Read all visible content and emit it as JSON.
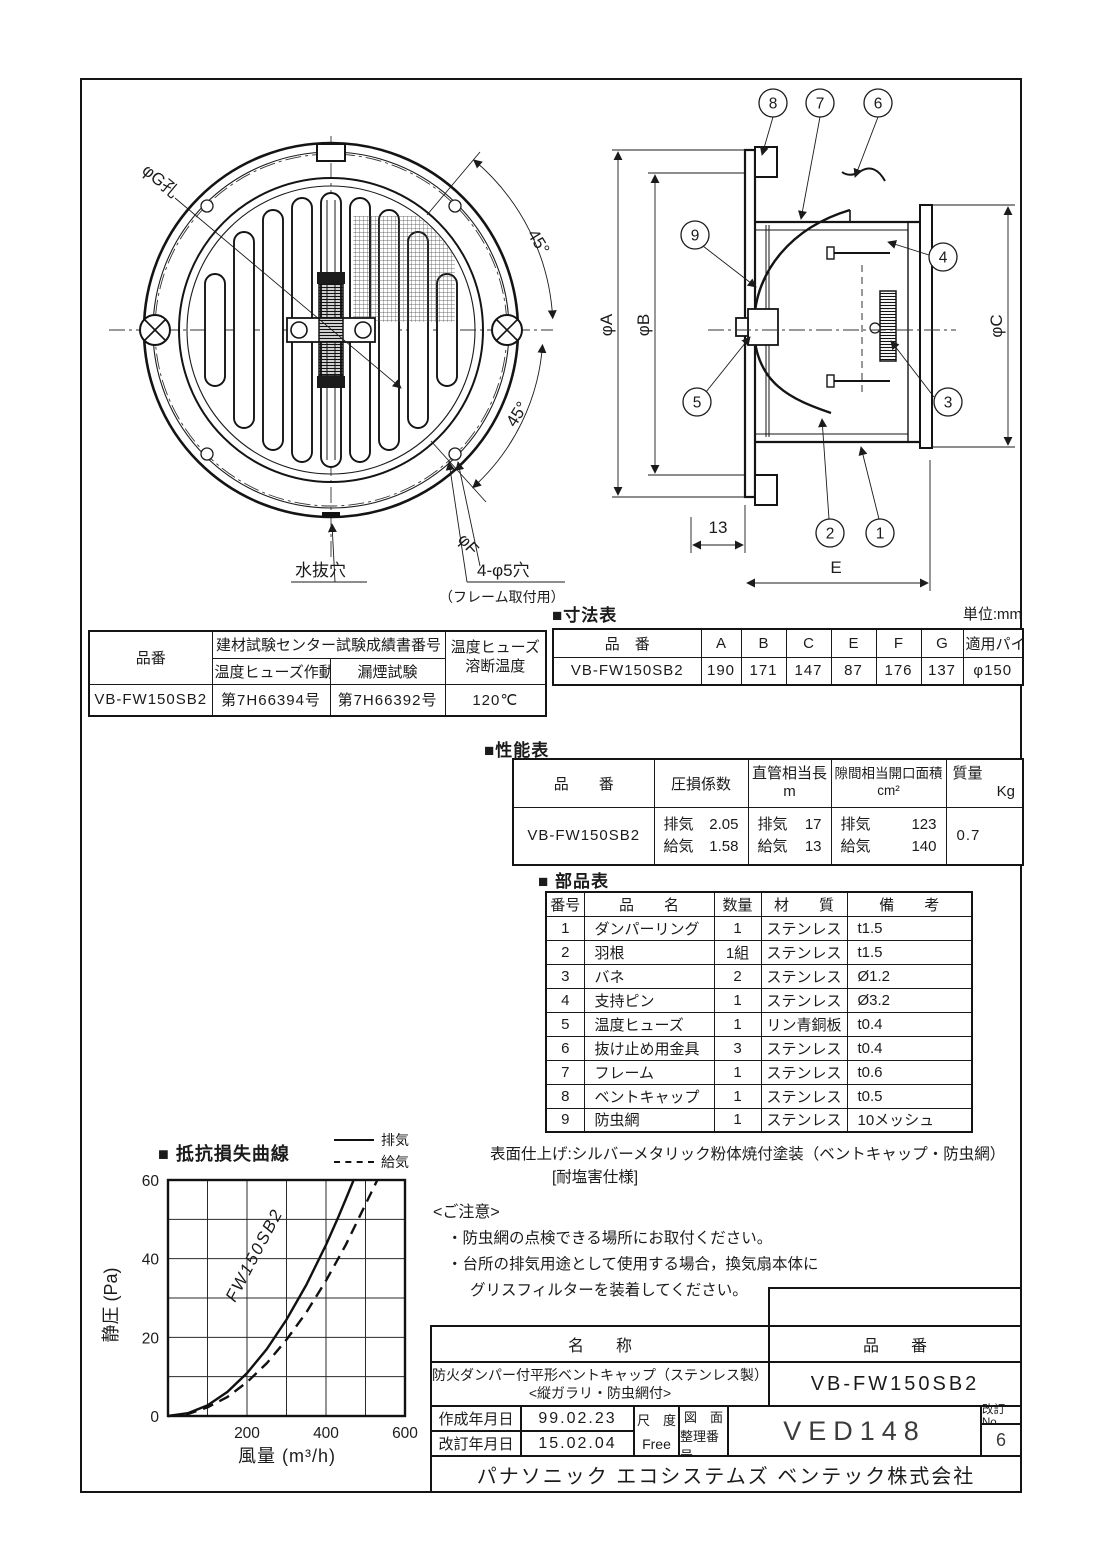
{
  "front_view": {
    "labels": {
      "hole_g": "φG孔",
      "angle_top": "45°",
      "angle_bottom": "45°",
      "bolt_circle": "φF",
      "drain": "水抜穴",
      "holes": "4-φ5穴",
      "holes_note": "（フレーム取付用）"
    }
  },
  "side_view": {
    "callouts": [
      "1",
      "2",
      "3",
      "4",
      "5",
      "6",
      "7",
      "8",
      "9"
    ],
    "dims": {
      "a": "φA",
      "b": "φB",
      "c": "φC",
      "d13": "13",
      "e": "E"
    }
  },
  "test_table": {
    "col_product": "品番",
    "group_header": "建材試験センター試験成績書番号",
    "sub_fuse_test": "温度ヒューズ作動試験",
    "sub_smoke_test": "漏煙試験",
    "fuse_temp_line1": "温度ヒューズ",
    "fuse_temp_line2": "溶断温度",
    "row": {
      "product": "VB-FW150SB2",
      "fuse_test_no": "第7H66394号",
      "smoke_test_no": "第7H66392号",
      "fuse_temp": "120℃"
    }
  },
  "dimension_table": {
    "title": "■寸法表",
    "unit": "単位:mm",
    "headers": [
      "品　番",
      "A",
      "B",
      "C",
      "E",
      "F",
      "G",
      "適用パイプ"
    ],
    "row": [
      "VB-FW150SB2",
      "190",
      "171",
      "147",
      "87",
      "176",
      "137",
      "φ150"
    ]
  },
  "performance_table": {
    "title": "■性能表",
    "h_product": "品　　番",
    "h_loss": "圧損係数",
    "h_duct_line1": "直管相当長",
    "h_duct_line2": "m",
    "h_gap_line1": "隙間相当開口面積",
    "h_gap_line2": "cm²",
    "h_mass_line1": "質量",
    "h_mass_line2": "Kg",
    "row": {
      "product": "VB-FW150SB2",
      "loss_exhaust": "排気",
      "loss_exhaust_v": "2.05",
      "loss_intake": "給気",
      "loss_intake_v": "1.58",
      "duct_exhaust": "排気",
      "duct_exhaust_v": "17",
      "duct_intake": "給気",
      "duct_intake_v": "13",
      "gap_exhaust": "排気",
      "gap_exhaust_v": "123",
      "gap_intake": "給気",
      "gap_intake_v": "140",
      "mass": "0.7"
    }
  },
  "parts_table": {
    "title": "■ 部品表",
    "headers": [
      "番号",
      "品　　名",
      "数量",
      "材　　質",
      "備　　考"
    ],
    "rows": [
      [
        "1",
        "ダンパーリング",
        "1",
        "ステンレス",
        "t1.5"
      ],
      [
        "2",
        "羽根",
        "1組",
        "ステンレス",
        "t1.5"
      ],
      [
        "3",
        "バネ",
        "2",
        "ステンレス",
        "Ø1.2"
      ],
      [
        "4",
        "支持ピン",
        "1",
        "ステンレス",
        "Ø3.2"
      ],
      [
        "5",
        "温度ヒューズ",
        "1",
        "リン青銅板",
        "t0.4"
      ],
      [
        "6",
        "抜け止め用金具",
        "3",
        "ステンレス",
        "t0.4"
      ],
      [
        "7",
        "フレーム",
        "1",
        "ステンレス",
        "t0.6"
      ],
      [
        "8",
        "ベントキャップ",
        "1",
        "ステンレス",
        "t0.5"
      ],
      [
        "9",
        "防虫網",
        "1",
        "ステンレス",
        "10メッシュ"
      ]
    ]
  },
  "finish_note": {
    "line1": "表面仕上げ:シルバーメタリック粉体焼付塗装（ベントキャップ・防虫網）",
    "line2": "[耐塩害仕様]"
  },
  "notice": {
    "title": "<ご注意>",
    "item1": "・防虫網の点検できる場所にお取付ください。",
    "item2": "・台所の排気用途として使用する場合，換気扇本体に",
    "item3": "グリスフィルターを装着してください。"
  },
  "chart_data": {
    "type": "line",
    "title": "■ 抵抗損失曲線",
    "xlabel": "風量 (m³/h)",
    "ylabel": "静圧 (Pa)",
    "xlim": [
      0,
      600
    ],
    "ylim": [
      0,
      60
    ],
    "x_ticks": [
      200,
      400,
      600
    ],
    "y_ticks": [
      0,
      20,
      40,
      60
    ],
    "grid_step_x": 100,
    "grid_step_y": 10,
    "grid": true,
    "legend_position": "top-right",
    "curve_label": "FW150SB2",
    "legend": [
      {
        "name": "排気",
        "style": "solid"
      },
      {
        "name": "給気",
        "style": "dashed"
      }
    ],
    "series": [
      {
        "name": "排気",
        "style": "solid",
        "x": [
          0,
          50,
          100,
          150,
          200,
          250,
          300,
          350,
          400,
          430,
          450,
          470
        ],
        "y": [
          0,
          0.7,
          2.7,
          6.1,
          10.9,
          17.0,
          24.5,
          33.3,
          43.5,
          50.3,
          55.1,
          60
        ]
      },
      {
        "name": "給気",
        "style": "dashed",
        "x": [
          0,
          50,
          100,
          150,
          200,
          250,
          300,
          350,
          400,
          450,
          500,
          530
        ],
        "y": [
          0,
          0.5,
          2.2,
          4.8,
          8.6,
          13.4,
          19.4,
          26.3,
          34.4,
          43.5,
          53.8,
          60
        ]
      }
    ]
  },
  "title_block": {
    "h_name": "名　　称",
    "h_product": "品　　番",
    "name_line1": "防火ダンパー付平形ベントキャップ（ステンレス製）",
    "name_line2": "<縦ガラリ・防虫網付>",
    "product": "VB-FW150SB2",
    "created_label": "作成年月日",
    "created": "99.02.23",
    "revised_label": "改訂年月日",
    "revised": "15.02.04",
    "scale_label": "尺　度",
    "scale": "Free",
    "dwg_label_line1": "図　面",
    "dwg_label_line2": "整理番号",
    "dwg_no": "VED148",
    "rev_label": "改訂No.",
    "rev_no": "6",
    "company": "パナソニック エコシステムズ ベンテック株式会社"
  }
}
